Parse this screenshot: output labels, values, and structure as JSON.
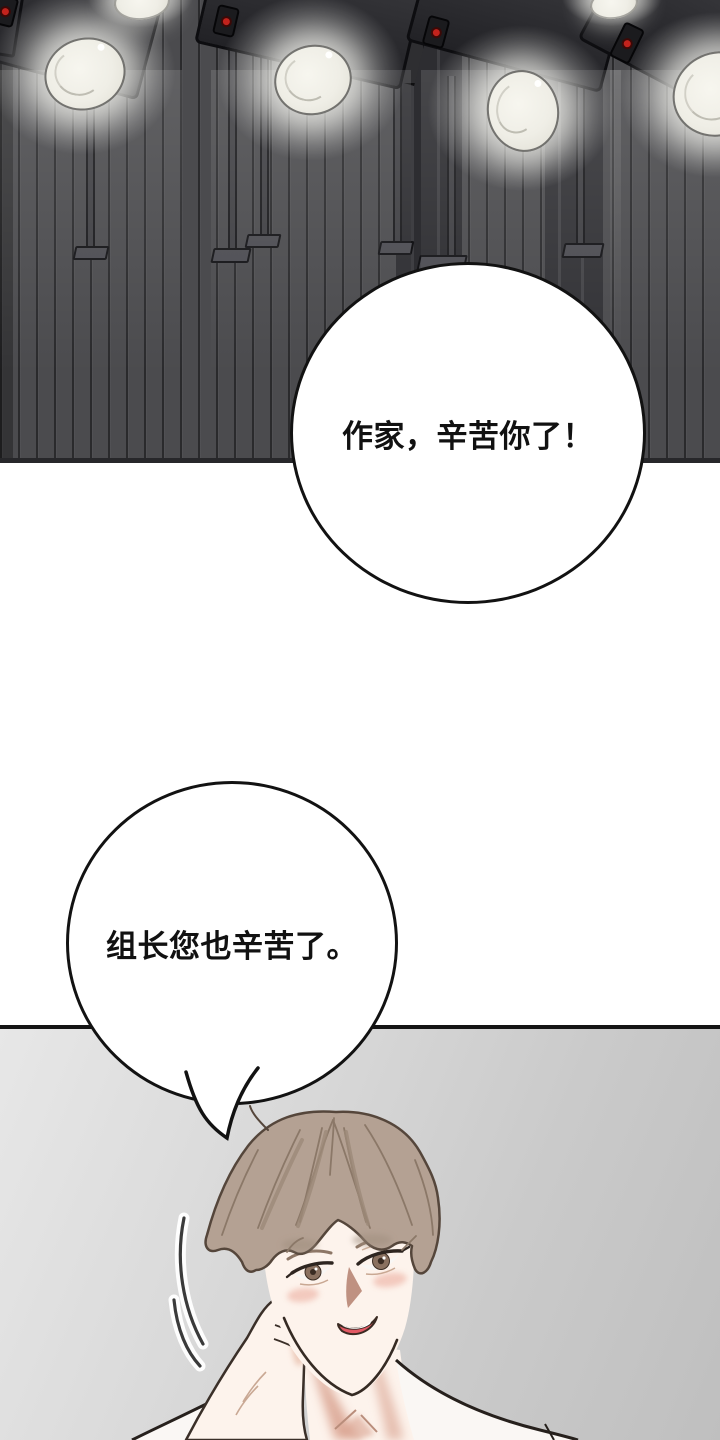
{
  "bubbles": {
    "top": {
      "text": "作家，辛苦你了！"
    },
    "bottom": {
      "text": "组长您也辛苦了。"
    }
  },
  "palette": {
    "wall": "#4b4b4e",
    "col": "#2d2d31",
    "lamp-body": "#2d2d31",
    "lamp-face": "#efeee6",
    "red": "#c2231d",
    "divider": "#141414",
    "bubble-fill": "#ffffff",
    "bubble-stroke": "#121212",
    "ink": "#111111",
    "hair": "#b4a193",
    "hair-line": "#55463b",
    "skin": "#fdf3ec",
    "skin-shadow": "#d9a28f",
    "blush": "#f1c2b6",
    "iris": "#8a7160",
    "mouth": "#e25964",
    "shirt": "#faf7f4",
    "outline": "#352a23"
  }
}
